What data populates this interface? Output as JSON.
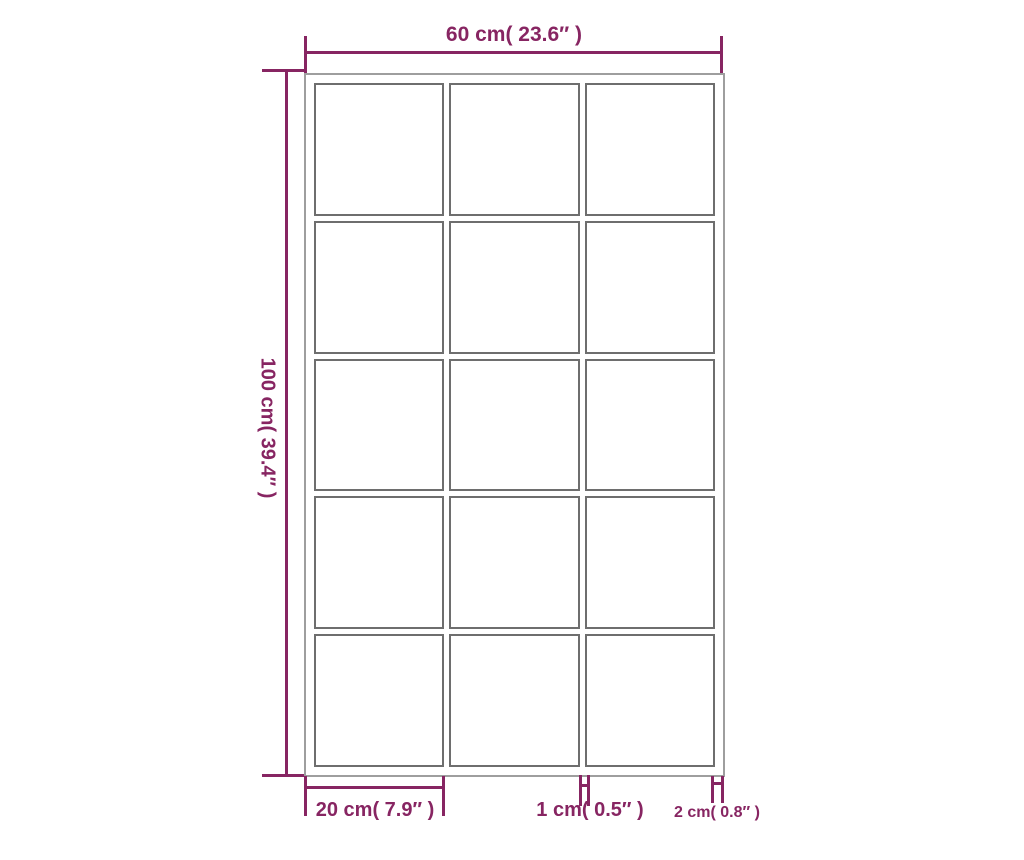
{
  "diagram": {
    "type": "product-dimension-diagram",
    "subject": "grid window frame with 15 panes (3 columns x 5 rows)",
    "colors": {
      "dimension_lines": "#872562",
      "pane_lines": "#6e6e6e",
      "outer_frame_line": "#9e9e9e",
      "background": "#ffffff"
    },
    "frame": {
      "columns": 3,
      "rows": 5,
      "pane_count": 15
    },
    "dimensions": {
      "overall_width": {
        "label": "60 cm( 23.6″ )"
      },
      "overall_height": {
        "label": "100 cm( 39.4″ )"
      },
      "pane_width": {
        "label": "20 cm( 7.9″ )"
      },
      "mullion_width": {
        "label": "1 cm( 0.5″ )"
      },
      "frame_thickness": {
        "label": "2 cm( 0.8″ )"
      }
    }
  }
}
